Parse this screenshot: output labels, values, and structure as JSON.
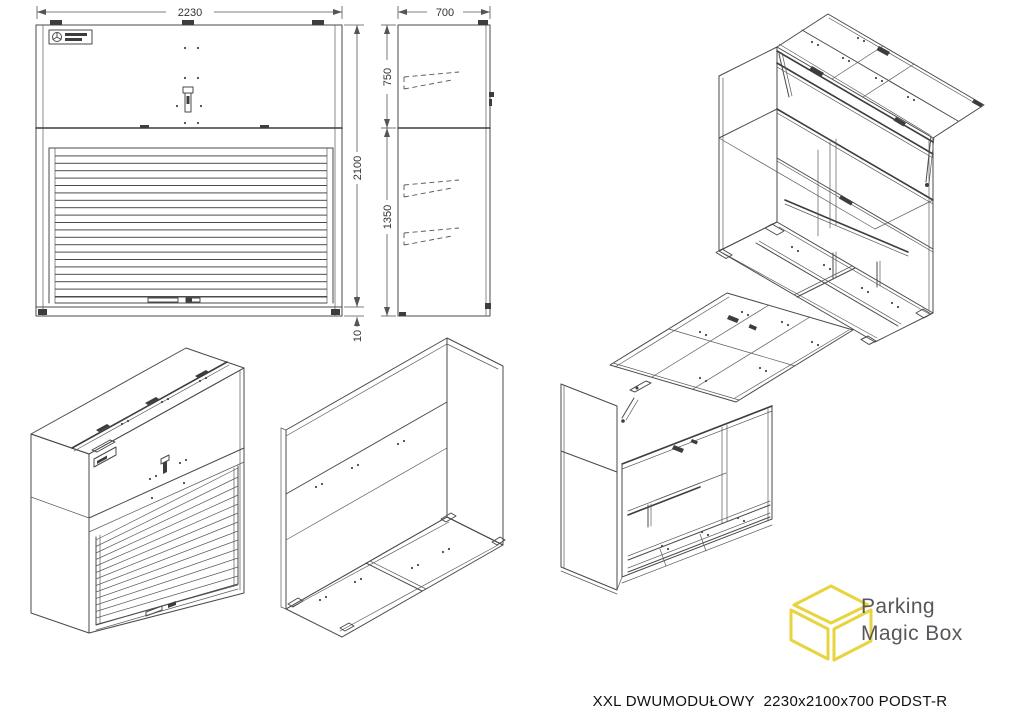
{
  "sheet": {
    "caption": "XXL DWUMODUŁOWY  2230x2100x700 PODST-R",
    "background": "#ffffff",
    "line_color": "#4a4a4a"
  },
  "dimensions": {
    "front": {
      "width": "2230",
      "height": "2100",
      "base": "10"
    },
    "side": {
      "depth": "700",
      "top_module": "750",
      "bottom_module": "1350"
    }
  },
  "brand": {
    "name_line1": "Parking",
    "name_line2": "Magic Box",
    "cube_color": "#e8d43e",
    "text_color": "#57585b"
  }
}
